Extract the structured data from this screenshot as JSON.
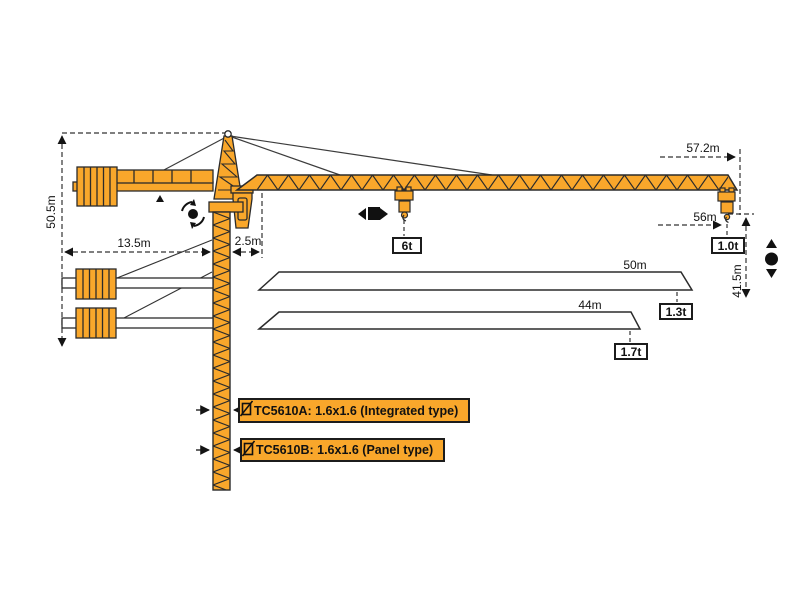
{
  "diagram": {
    "type": "tower-crane-specification-diagram",
    "colors": {
      "crane": "#F9A72B",
      "line": "#2b2b2b",
      "background": "#ffffff"
    },
    "dims": {
      "total_height": "50.5m",
      "counter_jib_length": "13.5m",
      "rear_clearance": "2.5m",
      "max_radius": "57.2m",
      "radius_56": "56m",
      "hook_height": "41.5m",
      "jib_option_50": "50m",
      "jib_option_44": "44m"
    },
    "loads": {
      "max_load": "6t",
      "tip_load_57m": "1.0t",
      "tip_load_50m": "1.3t",
      "tip_load_44m": "1.7t"
    },
    "models": {
      "a": "TC5610A:  1.6x1.6 (Integrated type)",
      "b": "TC5610B:  1.6x1.6 (Panel type)"
    }
  }
}
